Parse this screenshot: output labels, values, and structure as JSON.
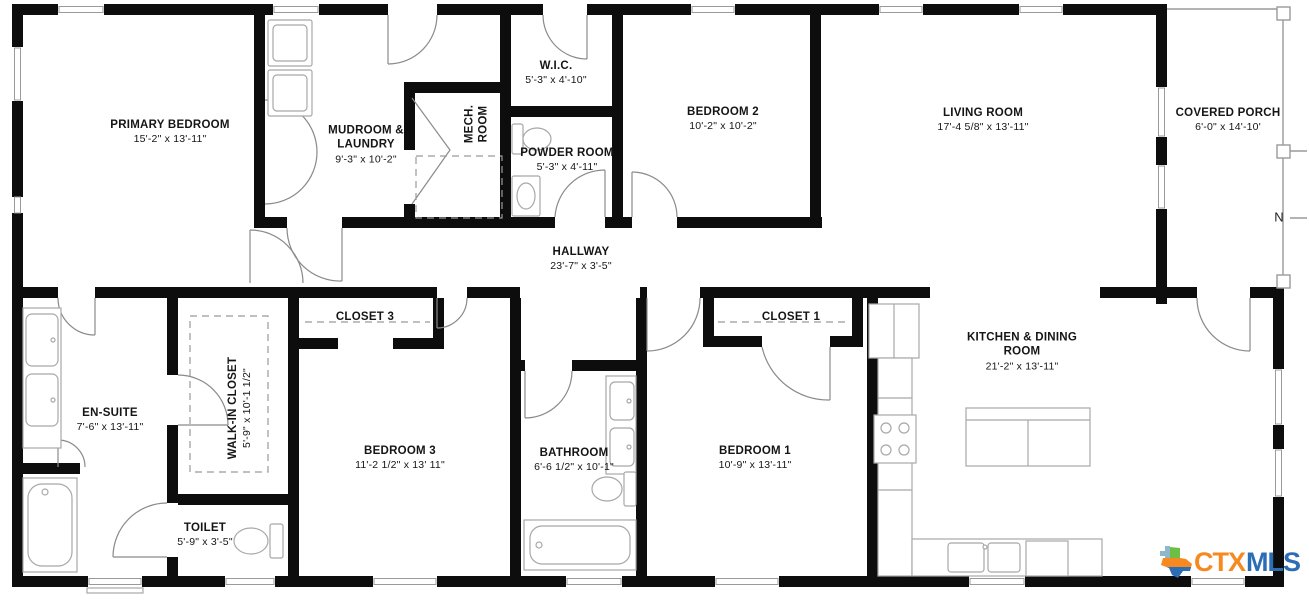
{
  "plan": {
    "background": "#ffffff",
    "wall_color": "#0d0d0d",
    "fixture_color": "#a8a8a8",
    "door_color": "#8a8a8a",
    "rooms": [
      {
        "id": "primary-bedroom",
        "name": "PRIMARY BEDROOM",
        "dims": "15'-2\" x 13'-11\""
      },
      {
        "id": "mudroom-laundry",
        "name": "MUDROOM & LAUNDRY",
        "dims": "9'-3\" x 10'-2\""
      },
      {
        "id": "mech-room",
        "name": "MECH. ROOM",
        "dims": ""
      },
      {
        "id": "wic",
        "name": "W.I.C.",
        "dims": "5'-3\" x 4'-10\""
      },
      {
        "id": "powder-room",
        "name": "POWDER ROOM",
        "dims": "5'-3\" x 4'-11\""
      },
      {
        "id": "bedroom-2",
        "name": "BEDROOM 2",
        "dims": "10'-2\" x 10'-2\""
      },
      {
        "id": "living-room",
        "name": "LIVING ROOM",
        "dims": "17'-4 5/8\" x 13'-11\""
      },
      {
        "id": "covered-porch",
        "name": "COVERED PORCH",
        "dims": "6'-0\" x 14'-10'"
      },
      {
        "id": "hallway",
        "name": "HALLWAY",
        "dims": "23'-7\" x 3'-5\""
      },
      {
        "id": "closet-3",
        "name": "CLOSET 3",
        "dims": ""
      },
      {
        "id": "closet-1",
        "name": "CLOSET 1",
        "dims": ""
      },
      {
        "id": "en-suite",
        "name": "EN-SUITE",
        "dims": "7'-6\" x 13'-11\""
      },
      {
        "id": "walk-in-closet",
        "name": "WALK-IN CLOSET",
        "dims": "5'-9\" x 10'-1 1/2\""
      },
      {
        "id": "bedroom-3",
        "name": "BEDROOM 3",
        "dims": "11'-2 1/2\" x 13' 11\""
      },
      {
        "id": "bathroom",
        "name": "BATHROOM",
        "dims": "6'-6 1/2\" x 10'-1\""
      },
      {
        "id": "bedroom-1",
        "name": "BEDROOM 1",
        "dims": "10'-9\" x 13'-11\""
      },
      {
        "id": "kitchen-dining",
        "name": "KITCHEN & DINING ROOM",
        "dims": "21'-2\" x 13'-11\""
      },
      {
        "id": "toilet",
        "name": "TOILET",
        "dims": "5'-9\" x 3'-5\""
      }
    ],
    "compass": {
      "label": "N"
    },
    "brand": {
      "icon": "texas-state-icon",
      "text_ctx": "CTX",
      "text_mls": "MLS",
      "ctx_color": "#F6891F",
      "mls_color": "#2C6EB5",
      "icon_green": "#6CBE45",
      "icon_orange": "#F6891F",
      "icon_blue": "#2C6EB5"
    }
  }
}
